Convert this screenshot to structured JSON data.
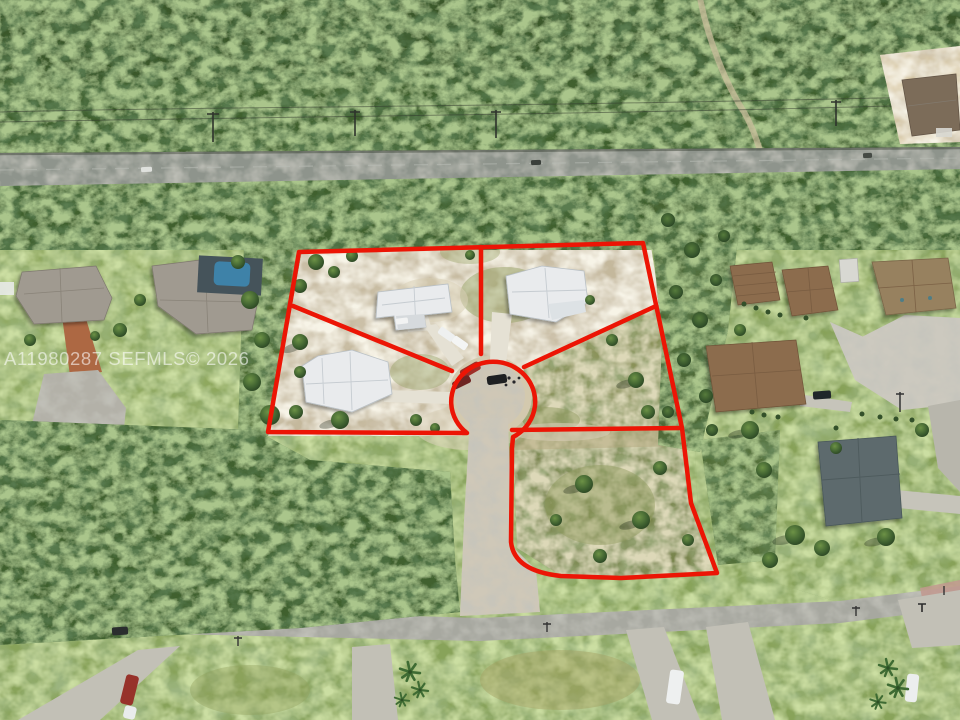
{
  "watermark": {
    "text": "A11980287 SEFMLS© 2026",
    "color": "rgba(255,255,255,0.58)"
  },
  "overlay": {
    "boundary_color": "#ec1505"
  },
  "scene": {
    "view": "aerial drone photo of wooded residential lots",
    "outlined_parcels": 5,
    "houses_inside_boundary": 3,
    "culdesac_vehicle_count": 3
  }
}
